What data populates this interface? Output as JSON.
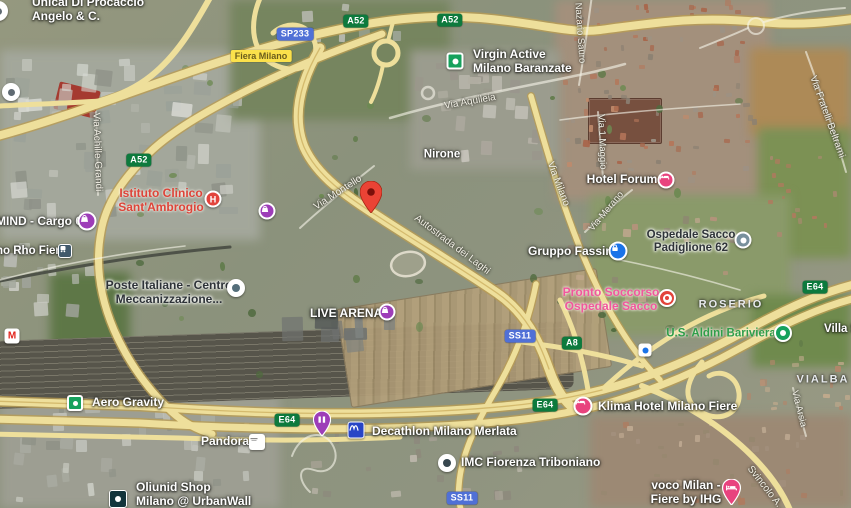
{
  "map_type": "satellite",
  "pois": {
    "unical": {
      "line1": "Unical Di Procaccio",
      "line2": "Angelo & C."
    },
    "fiera_milano": "Fiera Milano",
    "virgin_active": {
      "line1": "Virgin Active",
      "line2": "Milano Baranzate"
    },
    "hotel_forum": "Hotel Forum",
    "istituto_clinico": {
      "line1": "Istituto Clinico",
      "line2": "Sant'Ambrogio"
    },
    "mind_cargo": "MIND - Cargo 6",
    "rho_fiera_station": "no Rho Fiera",
    "poste_italiane": {
      "line1": "Poste Italiane - Centro",
      "line2": "Meccanizzazione..."
    },
    "gruppo_fassina": "Gruppo Fassina",
    "ospedale_sacco": {
      "line1": "Ospedale Sacco",
      "line2": "Padiglione 62"
    },
    "pronto_soccorso": {
      "line1": "Pronto Soccorso",
      "line2": "Ospedale Sacco"
    },
    "aldini": "U.S. Aldini Bariviera",
    "villa": "Villa S",
    "live_arena": "LIVE ARENA",
    "aero_gravity": "Aero Gravity",
    "klima_hotel": "Klima Hotel Milano Fiere",
    "pandora": "Pandora",
    "decathlon": "Decathlon Milano Merlata",
    "imc_fiorenza": "IMC Fiorenza Triboniano",
    "voco": {
      "line1": "voco Milan -",
      "line2": "Fiere by IHG"
    },
    "oliunid": {
      "line1": "Oliunid Shop",
      "line2": "Milano @ UrbanWall"
    }
  },
  "districts": {
    "nirone": "Nirone",
    "roserio": "ROSERIO",
    "vialba": "VIALBA"
  },
  "streets": {
    "via_aquileia": "Via Aquileia",
    "nazario_sauro": "Nazario Sauro",
    "via_fratelli_beltrami": "Via Fratelli Beltrami",
    "via_montello": "Via Montello",
    "autostrada_dei_laghi": "Autostrada dei Laghi",
    "via_achille_grandi": "Via Achille Grandi",
    "via_milano": "Via Milano",
    "via_1_maggio": "Via 1 Maggio",
    "via_merano": "Via Merano",
    "via_arsia": "Via Arsia",
    "svincolo": "Svincolo A..."
  },
  "shields": {
    "a52": "A52",
    "sp233": "SP233",
    "e64": "E64",
    "a8": "A8",
    "ss11": "SS11"
  },
  "glyphs": {
    "hospital_h": "H",
    "metro_m": "M"
  },
  "icons": {
    "destination": "red-map-pin-icon",
    "shopping": "purple-bag-circle-icon",
    "hotel": "pink-bed-circle-icon",
    "hospital": "red-h-circle-icon",
    "emergency": "white-red-dot-circle-icon",
    "sports": "green-dot-circle-icon",
    "generic_poi": "white-gray-dot-circle-icon",
    "car_dealer": "blue-lock-circle-icon",
    "train_station": "dark-train-square-icon",
    "metro": "white-red-m-square-icon",
    "store_logo": "white-square-logo-icon",
    "climbing": "dark-dot-square-icon",
    "decathlon_logo": "blue-wave-square-icon",
    "school": "white-blue-dot-square-icon"
  },
  "colors": {
    "highway_yellow": "#eedf9b",
    "highway_casing": "#b99c52",
    "shield_green": "#0d7a3d",
    "shield_blue": "#5070d6",
    "pin_red": "#ea4335",
    "poi_purple": "#9d3db8",
    "poi_pink": "#e8437e",
    "poi_blue": "#1a73e8",
    "poi_green": "#16a15d",
    "hospital_text_red": "#dd4439",
    "emergency_text_pink": "#f1579d",
    "sports_text_green": "#2f9e49"
  }
}
